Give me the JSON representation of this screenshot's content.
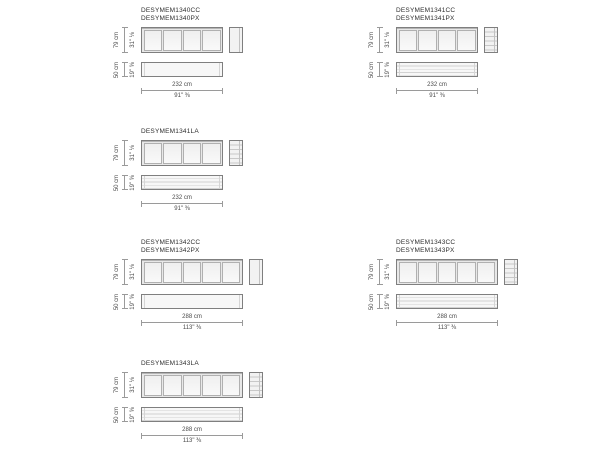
{
  "colors": {
    "rect_border": "#7f7f7f",
    "dimension_line": "#9a9a9a",
    "text": "#2f2f2f",
    "panel_fill": "#f4f4f4"
  },
  "groups": [
    {
      "titles": [
        "DESYMEM1340CC",
        "DESYMEM1340PX"
      ],
      "panels": 4,
      "features": {
        "side_drawers": false,
        "lower_drawers": false
      },
      "dims": {
        "height_cm": "79 cm",
        "height_in": "31\" ⅛",
        "depth_cm": "50 cm",
        "depth_in": "19\" ⅝",
        "width_cm": "232 cm",
        "width_in": "91\" ⅜"
      }
    },
    {
      "titles": [
        "DESYMEM1341CC",
        "DESYMEM1341PX"
      ],
      "panels": 4,
      "features": {
        "side_drawers": true,
        "lower_drawers": true
      },
      "dims": {
        "height_cm": "79 cm",
        "height_in": "31\" ⅛",
        "depth_cm": "50 cm",
        "depth_in": "19\" ⅝",
        "width_cm": "232 cm",
        "width_in": "91\" ⅜"
      }
    },
    {
      "titles": [
        "DESYMEM1341LA"
      ],
      "panels": 4,
      "features": {
        "side_drawers": true,
        "lower_drawers": true
      },
      "dims": {
        "height_cm": "79 cm",
        "height_in": "31\" ⅛",
        "depth_cm": "50 cm",
        "depth_in": "19\" ⅝",
        "width_cm": "232 cm",
        "width_in": "91\" ⅜"
      }
    },
    {
      "titles": [
        "DESYMEM1342CC",
        "DESYMEM1342PX"
      ],
      "panels": 5,
      "features": {
        "side_drawers": false,
        "lower_drawers": false
      },
      "dims": {
        "height_cm": "79 cm",
        "height_in": "31\" ⅛",
        "depth_cm": "50 cm",
        "depth_in": "19\" ⅝",
        "width_cm": "288 cm",
        "width_in": "113\" ⅜"
      }
    },
    {
      "titles": [
        "DESYMEM1343CC",
        "DESYMEM1343PX"
      ],
      "panels": 5,
      "features": {
        "side_drawers": true,
        "lower_drawers": true
      },
      "dims": {
        "height_cm": "79 cm",
        "height_in": "31\" ⅛",
        "depth_cm": "50 cm",
        "depth_in": "19\" ⅝",
        "width_cm": "288 cm",
        "width_in": "113\" ⅜"
      }
    },
    {
      "titles": [
        "DESYMEM1343LA"
      ],
      "panels": 5,
      "features": {
        "side_drawers": true,
        "lower_drawers": true
      },
      "dims": {
        "height_cm": "79 cm",
        "height_in": "31\" ⅛",
        "depth_cm": "50 cm",
        "depth_in": "19\" ⅝",
        "width_cm": "288 cm",
        "width_in": "113\" ⅜"
      }
    }
  ]
}
